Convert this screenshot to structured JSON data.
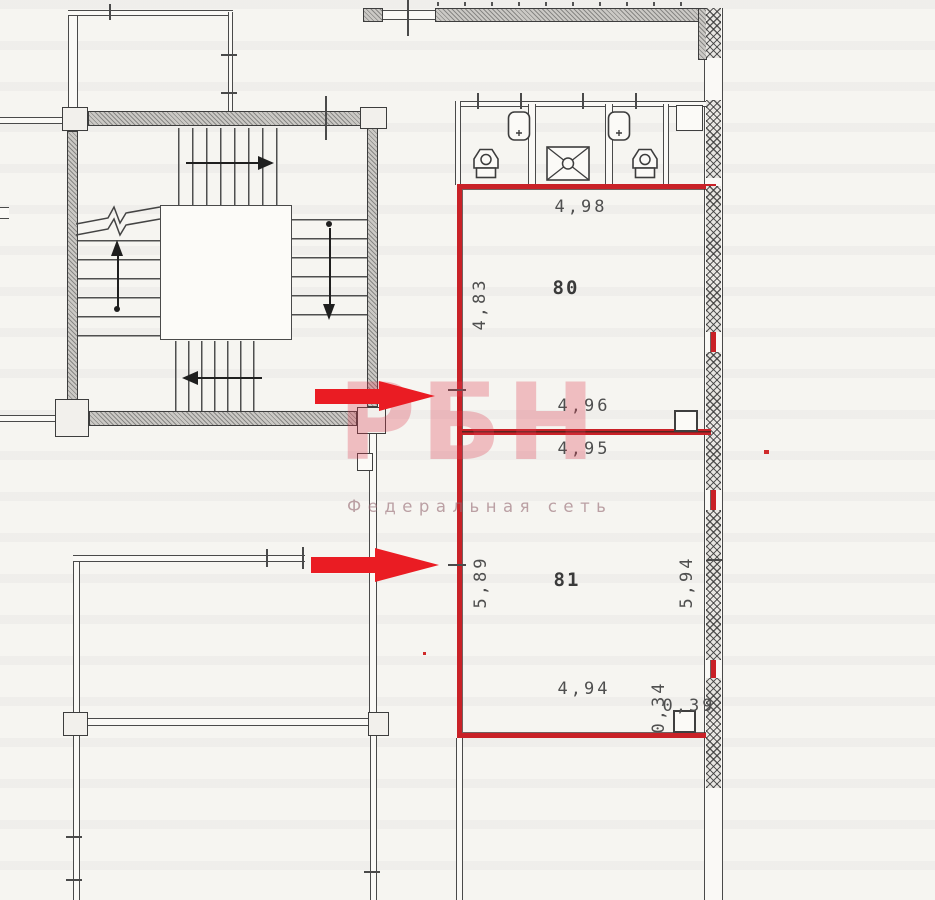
{
  "document": {
    "type": "floor-plan-scan",
    "description": "Scanned building floor plan fragment with stairwell, sanitary block and two highlighted premises"
  },
  "watermark": {
    "brand": "РБН",
    "tagline": "Федеральная сеть",
    "brand_color": "#dd3a50",
    "tagline_color": "#966c74"
  },
  "rooms": [
    {
      "number": "80",
      "dim_top": "4,98",
      "dim_side": "4,83",
      "dim_bottom": "4,96"
    },
    {
      "number": "81",
      "dim_top": "4,95",
      "dim_side_left": "5,89",
      "dim_side_right": "5,94",
      "dim_bottom": "4,94",
      "niche_depth": "0,34",
      "niche_width": "0,39"
    }
  ],
  "labels": {
    "room80_top": "4,98",
    "room80_side": "4,83",
    "room80_number": "80",
    "room80_bottom": "4,96",
    "room81_top": "4,95",
    "room81_number": "81",
    "room81_side_left": "5,89",
    "room81_side_right": "5,94",
    "room81_bottom": "4,94",
    "niche_depth": "0,34",
    "niche_width": "0,39"
  },
  "plan_symbols": {
    "fixtures": [
      "toilet-icon",
      "sink-icon",
      "shower-tray-icon",
      "toilet-icon",
      "sink-icon",
      "duct-box-icon"
    ],
    "stair_marks": [
      "up-arrow",
      "down-arrow",
      "left-arrow",
      "right-arrow",
      "break-line"
    ]
  },
  "annotations": {
    "arrow_count": 2,
    "arrow_color": "#ea1c23",
    "highlight_color": "#c92127"
  },
  "colors": {
    "paper": "#f6f5f1",
    "wall_line": "#3d3d3d",
    "wall_fill": "#cbc9c5",
    "dim_text": "#4f4f4f"
  }
}
